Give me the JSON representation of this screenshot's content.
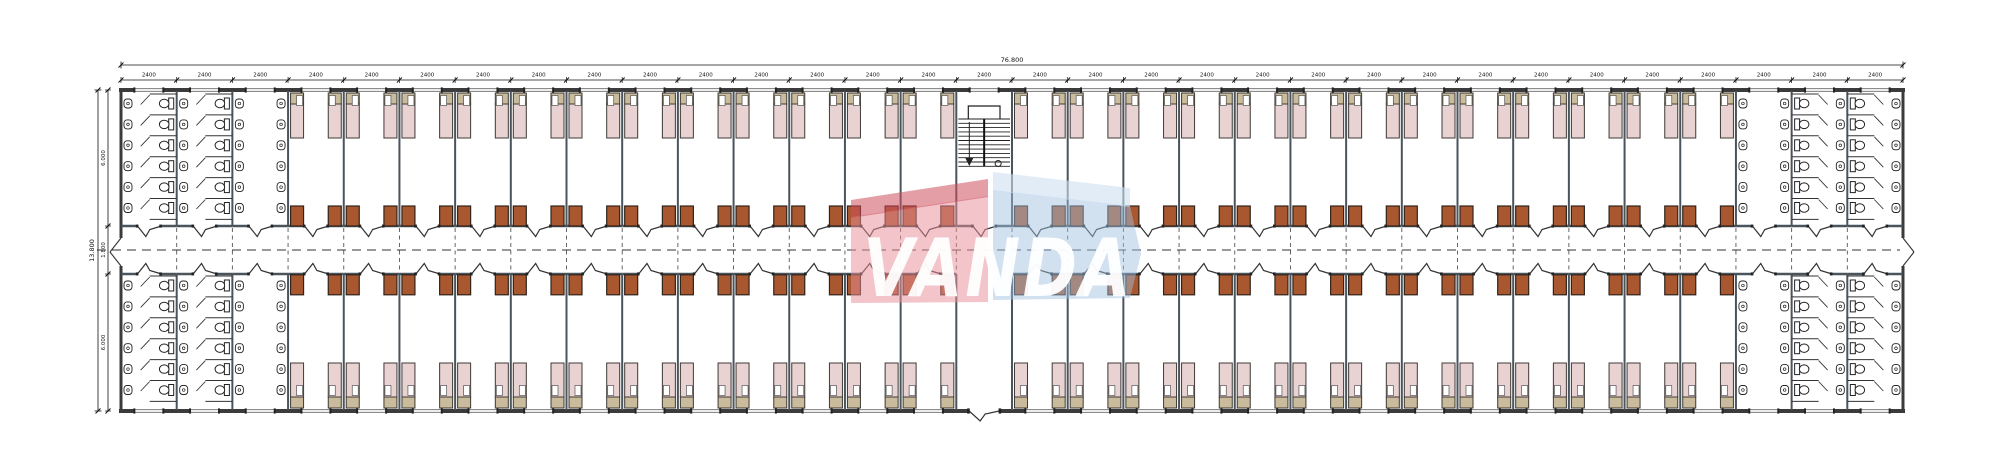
{
  "watermark": {
    "text": "VANDA",
    "pink_body": "#e88d98",
    "pink_flap": "#ce4f5c",
    "blue_body": "#9fc0e0",
    "blue_flap": "#cfe0f0"
  },
  "dimensions": {
    "top_total": "76.800",
    "bay_label": "2400",
    "left_total": "13.800",
    "left_segments": [
      "6.000",
      "1.800",
      "6.000"
    ]
  },
  "plan": {
    "bay_count": 32,
    "left": 121,
    "right": 1903,
    "top": 90,
    "bottom": 411,
    "corridor_top": 226,
    "corridor_bottom": 274,
    "centerline_y": 250,
    "stair_bay": 16,
    "entrance_bay": 16,
    "room_bays_top": [
      [
        4,
        15
      ],
      [
        17,
        29
      ]
    ],
    "room_bays_bottom": [
      [
        4,
        15
      ],
      [
        17,
        29
      ]
    ],
    "sanitary": {
      "toilet_bays_left": [
        1,
        2
      ],
      "wash_bay_left": 3,
      "wash_bay_right": 30,
      "toilet_bays_right": [
        31,
        32
      ],
      "stalls_per_column": 6,
      "beds_per_room": 2
    },
    "colors": {
      "wall": "#3b3b3b",
      "partition": "#4a545c",
      "bed_fill": "#e9d2d2",
      "bed_head": "#c9bb9b",
      "bed_stroke": "#3f3a35",
      "desk_fill": "#a9572f",
      "desk_stroke": "#30241c",
      "line": "#333333",
      "dim": "#111111"
    }
  }
}
